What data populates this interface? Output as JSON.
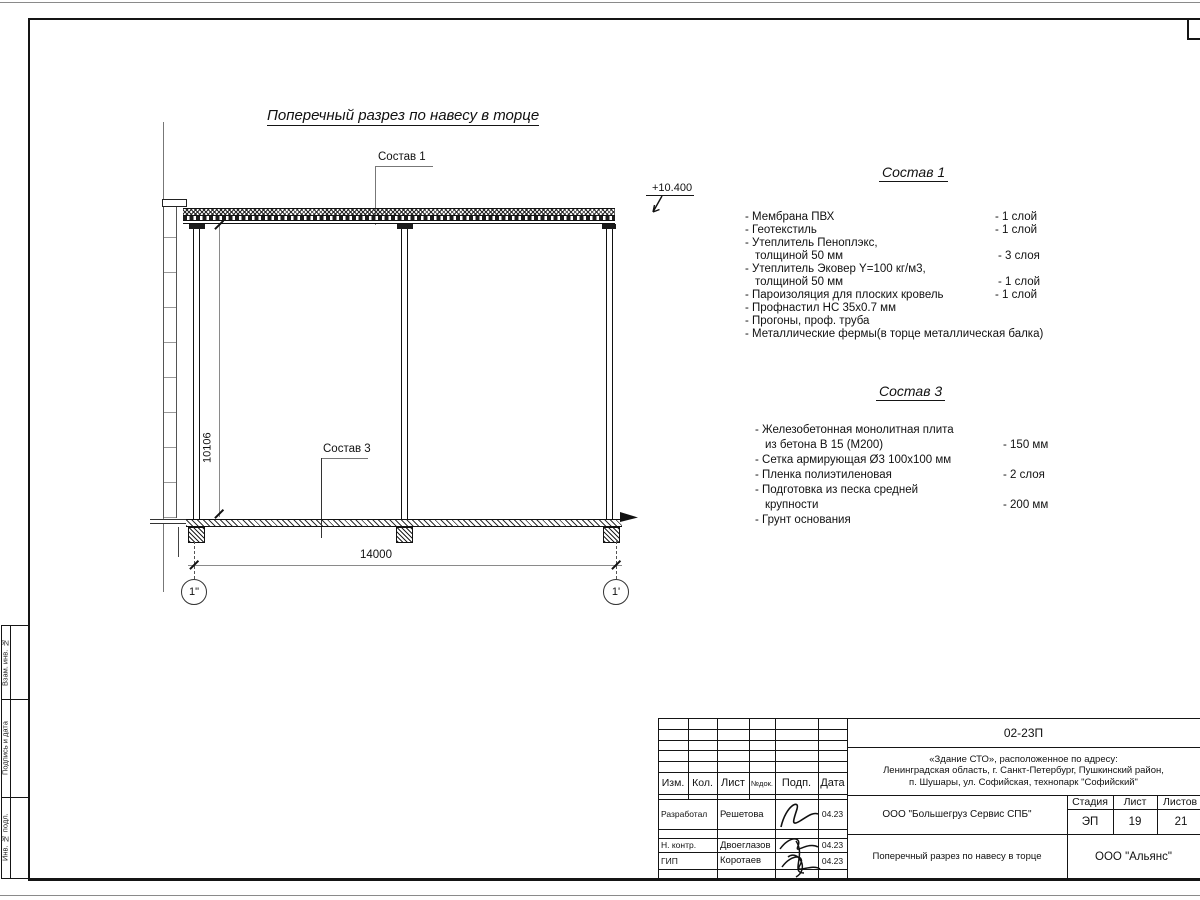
{
  "colors": {
    "line": "#151515",
    "paper": "#ffffff",
    "dim_line": "#8a8a8a"
  },
  "sheet": {
    "title": "Поперечный разрез по навесу в торце",
    "elevation": "+10.400",
    "dim_width": "14000",
    "dim_height": "10106",
    "axis_left": "1\"",
    "axis_right": "1'",
    "callout_roof": "Состав 1",
    "callout_floor": "Состав 3"
  },
  "sostav1": {
    "heading": "Состав 1",
    "rows": [
      {
        "text": "- Мембрана ПВХ",
        "qty": "- 1 слой"
      },
      {
        "text": "- Геотекстиль",
        "qty": "- 1 слой"
      },
      {
        "text": "- Утеплитель Пеноплэкс,",
        "qty": ""
      },
      {
        "text": "толщиной 50 мм",
        "qty": "- 3 слоя"
      },
      {
        "text": "- Утеплитель Эковер Y=100 кг/м3,",
        "qty": ""
      },
      {
        "text": "толщиной 50 мм",
        "qty": "- 1 слой"
      },
      {
        "text": "- Пароизоляция для плоских кровель",
        "qty": "- 1 слой"
      },
      {
        "text": "- Профнастил НС 35х0.7 мм",
        "qty": ""
      },
      {
        "text": "- Прогоны, проф. труба",
        "qty": ""
      },
      {
        "text": "- Металлические фермы(в торце металлическая балка)",
        "qty": ""
      }
    ]
  },
  "sostav3": {
    "heading": "Состав 3",
    "rows": [
      {
        "text": "- Железобетонная  монолитная плита",
        "qty": ""
      },
      {
        "text": "из бетона В 15 (М200)",
        "qty": "- 150 мм"
      },
      {
        "text": "- Сетка армирующая Ø3 100х100 мм",
        "qty": ""
      },
      {
        "text": "- Пленка полиэтиленовая",
        "qty": "-  2 слоя"
      },
      {
        "text": "- Подготовка из песка средней",
        "qty": ""
      },
      {
        "text": "крупности",
        "qty": "- 200 мм"
      },
      {
        "text": "- Грунт основания",
        "qty": ""
      }
    ]
  },
  "titleblock": {
    "code": "02-23П",
    "address1": "«Здание СТО», расположенное по адресу:",
    "address2": "Ленинградская область, г. Санкт-Петербург, Пушкинский район,",
    "address3": "п. Шушары, ул. Софийская, технопарк \"Софийский\"",
    "col_izm": "Изм.",
    "col_kol": "Кол.",
    "col_list": "Лист",
    "col_ndok": "№док.",
    "col_podp": "Подп.",
    "col_data": "Дата",
    "row1_role": "Разработал",
    "row1_name": "Решетова",
    "row1_date": "04.23",
    "row2_role": "Н. контр.",
    "row2_name": "Двоеглазов",
    "row2_date": "04.23",
    "row3_role": "ГИП",
    "row3_name": "Коротаев",
    "row3_date": "04.23",
    "company": "ООО \"Большегруз Сервис СПБ\"",
    "stage_label": "Стадия",
    "stage": "ЭП",
    "sheet_label": "Лист",
    "sheet_num": "19",
    "sheets_label": "Листов",
    "sheets_num": "21",
    "doc_title": "Поперечный разрез по навесу в торце",
    "org": "ООО \"Альянс\""
  },
  "margin": {
    "label1": "Взам. инв. №",
    "label2": "Подпись и дата",
    "label3": "Инв. № подл."
  }
}
